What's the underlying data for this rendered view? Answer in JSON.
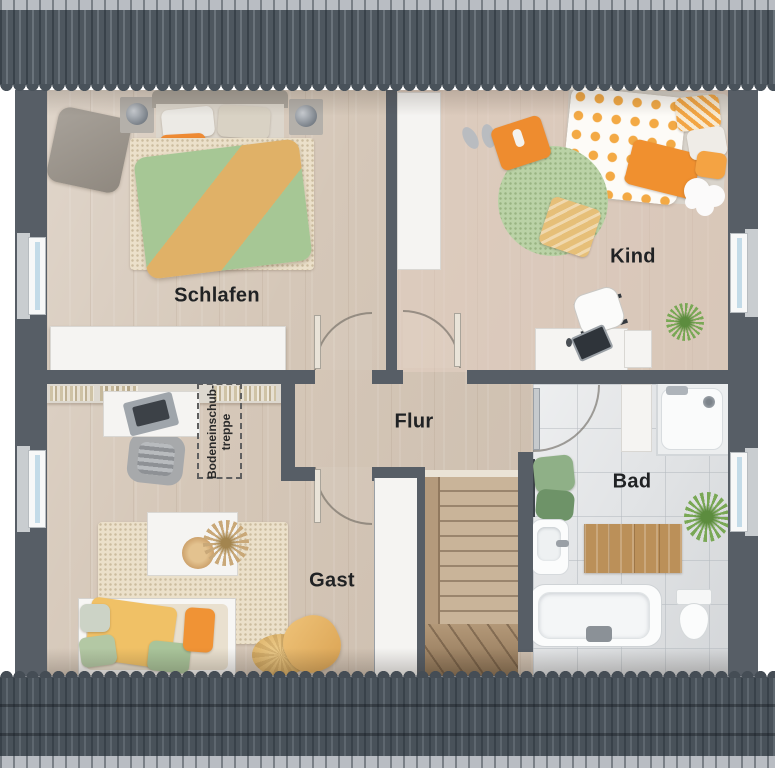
{
  "rooms": {
    "schlafen": {
      "label": "Schlafen"
    },
    "kind": {
      "label": "Kind"
    },
    "flur": {
      "label": "Flur"
    },
    "gast": {
      "label": "Gast"
    },
    "bad": {
      "label": "Bad"
    }
  },
  "annotations": {
    "attic_hatch": {
      "line1": "Bodeneinschub-",
      "line2": "treppe"
    }
  },
  "colors": {
    "roof": "#4d565e",
    "roof_ridge": "#b9bdc3",
    "wall": "#575e66",
    "wood_floor": "#d5c7b8",
    "kind_floor_tint": "#ead4c7",
    "bath_tile": "#e2e4e6",
    "stair_wood": "#c4ad8f",
    "window_glass": "#c3dbe8",
    "accent_orange": "#ee8c2f",
    "accent_green": "#a6c795",
    "accent_yellow": "#e8bd6e",
    "label_text": "#202224"
  }
}
